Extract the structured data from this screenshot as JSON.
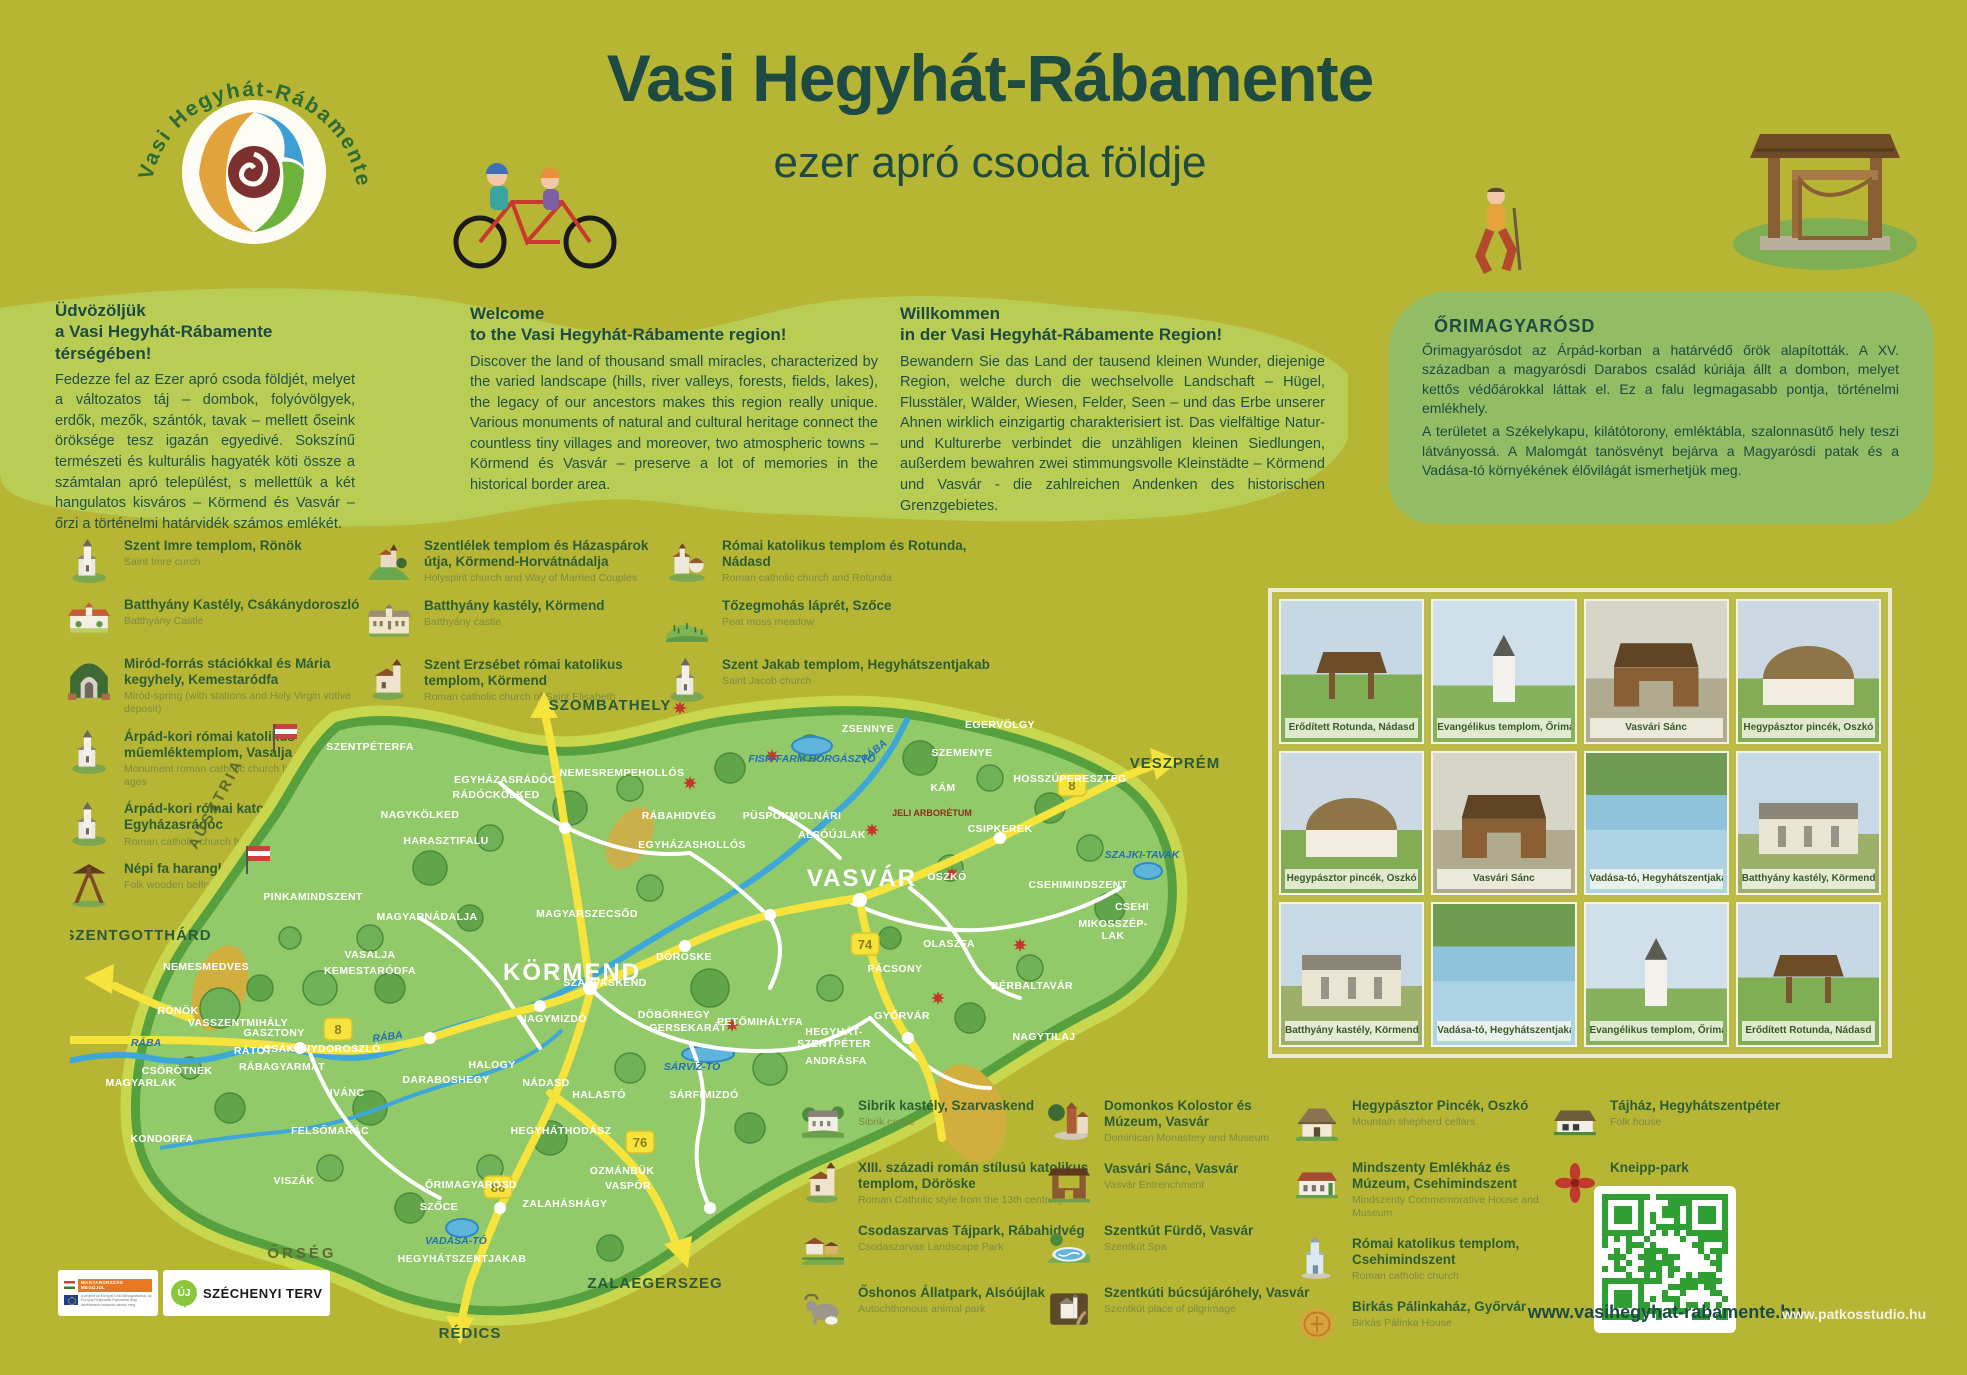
{
  "header": {
    "title": "Vasi Hegyhát-Rábamente",
    "subtitle": "ezer apró csoda földje",
    "logo_text": "Vasi Hegyhát-Rábamente"
  },
  "intro": {
    "hu": {
      "title1": "Üdvözöljük",
      "title2": "a Vasi Hegyhát-Rábamente térségében!",
      "body": "Fedezze fel az Ezer apró csoda földjét, melyet a változatos táj – dombok, folyóvölgyek, erdők, mezők, szántók, tavak – mellett őseink öröksége tesz igazán egyedivé. Sokszínű természeti és kulturális hagyaték köti össze a számtalan apró települést, s mellettük a két hangulatos kisváros – Körmend és Vasvár – őrzi a történelmi határvidék számos emlékét."
    },
    "en": {
      "title1": "Welcome",
      "title2": "to the Vasi Hegyhát-Rábamente region!",
      "body": "Discover the land of thousand small miracles, characterized by the varied landscape (hills, river valleys, forests, fields, lakes), the legacy of our ancestors makes this region really unique. Various monuments of natural and cultural heritage connect the countless tiny villages and moreover, two atmospheric towns – Körmend és Vasvár – preserve a lot of memories in the historical border area."
    },
    "de": {
      "title1": "Willkommen",
      "title2": "in der Vasi Hegyhát-Rábamente Region!",
      "body": "Bewandern Sie das Land der tausend kleinen Wunder, diejenige Region, welche durch die wechselvolle Landschaft – Hügel, Flusstäler, Wälder, Wiesen, Felder, Seen – und das Erbe unserer Ahnen wirklich einzigartig charakterisiert ist. Das vielfältige Natur- und Kulturerbe verbindet die unzähligen kleinen Siedlungen, außerdem bewahren zwei stimmungsvolle Kleinstädte – Körmend und Vasvár - die zahlreichen Andenken des historischen Grenzgebietes."
    },
    "ori": {
      "title": "ŐRIMAGYARÓSD",
      "body1": "Őrimagyarósdot az Árpád-korban a határvédő őrök alapították. A XV. században a magyarósdi Darabos család kúriája állt a dombon, melyet kettős védőárokkal láttak el. Ez a falu legmagasabb pontja, történelmi emlékhely.",
      "body2": "A területet a Székelykapu, kilátótorony, emléktábla, szalonnasütő hely teszi látványossá. A Malomgát tanösvényt bejárva a Magyarósdi patak és a Vadása-tó környékének élővilágát ismerhetjük meg."
    }
  },
  "legend_top": {
    "col1": [
      {
        "icon": "church",
        "title": "Szent Imre templom, Rönök",
        "sub": "Saint Imre curch"
      },
      {
        "icon": "castle",
        "title": "Batthyány Kastély, Csákánydoroszló",
        "sub": "Batthyány Castle"
      },
      {
        "icon": "grotto",
        "title": "Miród-forrás stációkkal és Mária kegyhely, Kemestaródfa",
        "sub": "Miród-spring (with stations and Holy Virgin votive deposit)"
      },
      {
        "icon": "church",
        "title": "Árpád-kori római katolikus műemléktemplom, Vasalja",
        "sub": "Monument roman catholic church from the Árpád-ages"
      },
      {
        "icon": "church",
        "title": "Árpád-kori római katolikus templom, Egyházasrádóc",
        "sub": "Roman catholic church from the Árpád-ages"
      },
      {
        "icon": "belfry",
        "title": "Népi fa harangláb, Daraboshegy",
        "sub": "Folk wooden belfry"
      }
    ],
    "col2": [
      {
        "icon": "hillchurch",
        "title": "Szentlélek templom és Házaspárok útja, Körmend-Horvátnádalja",
        "sub": "Holyspirit church and Way of Married Couples"
      },
      {
        "icon": "mansion",
        "title": "Batthyány kastély, Körmend",
        "sub": "Batthyány castle"
      },
      {
        "icon": "churchred",
        "title": "Szent Erzsébet római katolikus templom, Körmend",
        "sub": "Roman catholic church of Saint Elisabeth"
      }
    ],
    "col3": [
      {
        "icon": "rotunda",
        "title": "Római katolikus templom és Rotunda, Nádasd",
        "sub": "Roman catholic church and Rotunda"
      },
      {
        "icon": "meadow",
        "title": "Tőzegmohás láprét, Szőce",
        "sub": "Peat moss meadow"
      },
      {
        "icon": "church",
        "title": "Szent Jakab templom, Hegyhátszentjakab",
        "sub": "Saint Jacob church"
      }
    ]
  },
  "legend_bottom": {
    "col1": [
      {
        "icon": "manor",
        "title": "Sibrik kastély, Szarvaskend",
        "sub": "Sibrik castle"
      },
      {
        "icon": "churchred",
        "title": "XIII. századi román stílusú katolikus templom, Döröske",
        "sub": "Roman Catholic style from the 13th centrury"
      },
      {
        "icon": "farm",
        "title": "Csodaszarvas Tájpark, Rábahidvég",
        "sub": "Csodaszarvas Landscape Park"
      },
      {
        "icon": "cow",
        "title": "Őshonos Állatpark, Alsóújlak",
        "sub": "Autochthonous animal park"
      }
    ],
    "col2": [
      {
        "icon": "monastery",
        "title": "Domonkos Kolostor és Múzeum, Vasvár",
        "sub": "Dominican Monastery and Museum"
      },
      {
        "icon": "woodgate",
        "title": "Vasvári Sánc, Vasvár",
        "sub": "Vasvár Entrenchment"
      },
      {
        "icon": "pool",
        "title": "Szentkút Fürdő, Vasvár",
        "sub": "Szentkút Spa"
      },
      {
        "icon": "pilgrim",
        "title": "Szentkúti búcsújáróhely, Vasvár",
        "sub": "Szentkút place of pilgrimage"
      }
    ],
    "col3": [
      {
        "icon": "cellar",
        "title": "Hegypásztor Pincék, Oszkó",
        "sub": "Mountain shepherd cellars"
      },
      {
        "icon": "mindszenty",
        "title": "Mindszenty Emlékház és Múzeum, Csehimindszent",
        "sub": "Mindszenty Commemorative House and Museum"
      },
      {
        "icon": "churchblue",
        "title": "Római katolikus templom, Csehimindszent",
        "sub": "Roman catholic church"
      },
      {
        "icon": "coin",
        "title": "Birkás Pálinkaház, Győrvár",
        "sub": "Birkás Pálinka House"
      }
    ],
    "col4": [
      {
        "icon": "folkhouse",
        "title": "Tájház, Hegyhátszentpéter",
        "sub": "Folk house"
      },
      {
        "icon": "flower",
        "title": "Kneipp-park",
        "sub": ""
      }
    ]
  },
  "photo_grid": {
    "photos": [
      {
        "caption": "Erődített Rotunda, Nádasd",
        "kind": "wood"
      },
      {
        "caption": "Evangélikus templom, Őrimagyarósd",
        "kind": "church"
      },
      {
        "caption": "Vasvári Sánc",
        "kind": "gate"
      },
      {
        "caption": "Hegypásztor pincék, Oszkó",
        "kind": "thatch"
      },
      {
        "caption": "Hegypásztor pincék, Oszkó",
        "kind": "thatch"
      },
      {
        "caption": "Vasvári Sánc",
        "kind": "gate"
      },
      {
        "caption": "Vadása-tó, Hegyhátszentjakab",
        "kind": "lake"
      },
      {
        "caption": "Batthyány kastély, Körmend",
        "kind": "palace"
      },
      {
        "caption": "Batthyány kastély, Körmend",
        "kind": "palace"
      },
      {
        "caption": "Vadása-tó, Hegyhátszentjakab",
        "kind": "lake"
      },
      {
        "caption": "Evangélikus templom, Őrimagyarósd",
        "kind": "church"
      },
      {
        "caption": "Erődített Rotunda, Nádasd",
        "kind": "wood"
      }
    ]
  },
  "map": {
    "labels": [
      {
        "t": "SZOMBATHELY",
        "x": 540,
        "y": 22,
        "c": "ext"
      },
      {
        "t": "VESZPRÉM",
        "x": 1105,
        "y": 80,
        "c": "ext"
      },
      {
        "t": "SZENTGOTTHÁRD",
        "x": 68,
        "y": 252,
        "c": "ext"
      },
      {
        "t": "ZALAEGERSZEG",
        "x": 585,
        "y": 600,
        "c": "ext"
      },
      {
        "t": "RÉDICS",
        "x": 400,
        "y": 650,
        "c": "ext"
      },
      {
        "t": "ŐRSÉG",
        "x": 232,
        "y": 570,
        "c": "area"
      },
      {
        "t": "AUSZTRIA",
        "x": 150,
        "y": 118,
        "c": "area",
        "r": -62
      },
      {
        "t": "KÖRMEND",
        "x": 502,
        "y": 292,
        "c": "city"
      },
      {
        "t": "VASVÁR",
        "x": 792,
        "y": 198,
        "c": "city"
      },
      {
        "t": "RÁBA",
        "x": 806,
        "y": 66,
        "c": "water",
        "r": -40
      },
      {
        "t": "RÁBA",
        "x": 318,
        "y": 352,
        "c": "water",
        "r": -8
      },
      {
        "t": "RÁBA",
        "x": 76,
        "y": 358,
        "c": "water"
      },
      {
        "t": "FISH-FARM HORGÁSZTÓ",
        "x": 742,
        "y": 74,
        "c": "water"
      },
      {
        "t": "SZAJKI-TAVAK",
        "x": 1072,
        "y": 170,
        "c": "water"
      },
      {
        "t": "SÁRVÍZ-TÓ",
        "x": 622,
        "y": 382,
        "c": "water"
      },
      {
        "t": "VADÁSA-TÓ",
        "x": 386,
        "y": 556,
        "c": "water"
      },
      {
        "t": "JELI ARBORÉTUM",
        "x": 862,
        "y": 128,
        "c": "special"
      },
      {
        "t": "ZSENNYE",
        "x": 798,
        "y": 44,
        "c": "town"
      },
      {
        "t": "EGERVÖLGY",
        "x": 930,
        "y": 40,
        "c": "town"
      },
      {
        "t": "SZEMENYE",
        "x": 892,
        "y": 68,
        "c": "town"
      },
      {
        "t": "HOSSZÚPERESZTEG",
        "x": 1000,
        "y": 94,
        "c": "town"
      },
      {
        "t": "NEMESREMPEHOLLÓS",
        "x": 552,
        "y": 88,
        "c": "town"
      },
      {
        "t": "EGYHÁZASRÁDÓC",
        "x": 435,
        "y": 95,
        "c": "town"
      },
      {
        "t": "RÁDÓCKÖLKED",
        "x": 426,
        "y": 110,
        "c": "town"
      },
      {
        "t": "NAGYKÖLKED",
        "x": 350,
        "y": 130,
        "c": "town"
      },
      {
        "t": "HARASZTIFALU",
        "x": 376,
        "y": 156,
        "c": "town"
      },
      {
        "t": "PINKAMINDSZENT",
        "x": 243,
        "y": 212,
        "c": "town"
      },
      {
        "t": "SZENTPÉTERFA",
        "x": 300,
        "y": 62,
        "c": "town"
      },
      {
        "t": "MAGYARNÁDALJA",
        "x": 357,
        "y": 232,
        "c": "town"
      },
      {
        "t": "VASALJA",
        "x": 300,
        "y": 270,
        "c": "town"
      },
      {
        "t": "KEMESTARÓDFA",
        "x": 300,
        "y": 286,
        "c": "town"
      },
      {
        "t": "NEMESMEDVES",
        "x": 136,
        "y": 282,
        "c": "town"
      },
      {
        "t": "RÖNÖK",
        "x": 108,
        "y": 326,
        "c": "town"
      },
      {
        "t": "VASSZENTMIHÁLY",
        "x": 168,
        "y": 338,
        "c": "town"
      },
      {
        "t": "GASZTONY",
        "x": 204,
        "y": 348,
        "c": "town"
      },
      {
        "t": "RÁTÓT",
        "x": 183,
        "y": 366,
        "c": "town"
      },
      {
        "t": "CSÁKÁNYDOROSZLÓ",
        "x": 252,
        "y": 364,
        "c": "town"
      },
      {
        "t": "RÁBAGYARMAT",
        "x": 212,
        "y": 382,
        "c": "town"
      },
      {
        "t": "MAGYARLAK",
        "x": 71,
        "y": 398,
        "c": "town"
      },
      {
        "t": "CSÖRÖTNEK",
        "x": 107,
        "y": 386,
        "c": "town"
      },
      {
        "t": "KONDORFA",
        "x": 92,
        "y": 454,
        "c": "town"
      },
      {
        "t": "IVÁNC",
        "x": 277,
        "y": 408,
        "c": "town"
      },
      {
        "t": "FELSŐMARÁC",
        "x": 260,
        "y": 446,
        "c": "town"
      },
      {
        "t": "VISZÁK",
        "x": 224,
        "y": 496,
        "c": "town"
      },
      {
        "t": "SZŐCE",
        "x": 369,
        "y": 522,
        "c": "town"
      },
      {
        "t": "ŐRIMAGYARÓSD",
        "x": 401,
        "y": 500,
        "c": "town"
      },
      {
        "t": "HEGYHÁTSZENTJAKAB",
        "x": 392,
        "y": 574,
        "c": "town"
      },
      {
        "t": "ZALAHÁSHÁGY",
        "x": 495,
        "y": 519,
        "c": "town"
      },
      {
        "t": "DARABOSHEGY",
        "x": 376,
        "y": 395,
        "c": "town"
      },
      {
        "t": "HALOGY",
        "x": 422,
        "y": 380,
        "c": "town"
      },
      {
        "t": "NÁDASD",
        "x": 476,
        "y": 398,
        "c": "town"
      },
      {
        "t": "HEGYHÁTHODÁSZ",
        "x": 491,
        "y": 446,
        "c": "town"
      },
      {
        "t": "OZMÁNBÜK",
        "x": 552,
        "y": 486,
        "c": "town"
      },
      {
        "t": "VASPÖR",
        "x": 558,
        "y": 501,
        "c": "town"
      },
      {
        "t": "HALASTÓ",
        "x": 529,
        "y": 410,
        "c": "town"
      },
      {
        "t": "MAGYARSZECSŐD",
        "x": 517,
        "y": 229,
        "c": "town"
      },
      {
        "t": "RÁBAHIDVÉG",
        "x": 609,
        "y": 131,
        "c": "town"
      },
      {
        "t": "PÜSPÖKMOLNÁRI",
        "x": 722,
        "y": 131,
        "c": "town"
      },
      {
        "t": "EGYHÁZASHOLLÓS",
        "x": 622,
        "y": 160,
        "c": "town"
      },
      {
        "t": "DÖRÖSKE",
        "x": 614,
        "y": 272,
        "c": "town"
      },
      {
        "t": "DÖBÖRHEGY",
        "x": 604,
        "y": 330,
        "c": "town"
      },
      {
        "t": "GERSEKARÁT",
        "x": 618,
        "y": 343,
        "c": "town"
      },
      {
        "t": "SZARVASKEND",
        "x": 535,
        "y": 298,
        "c": "town"
      },
      {
        "t": "NAGYMIZDÓ",
        "x": 483,
        "y": 334,
        "c": "town"
      },
      {
        "t": "SÁRFIMIZDÓ",
        "x": 634,
        "y": 410,
        "c": "town"
      },
      {
        "t": "PETŐMIHÁLYFA",
        "x": 690,
        "y": 337,
        "c": "town"
      },
      {
        "t": "HEGYHÁT-",
        "x": 764,
        "y": 347,
        "c": "town"
      },
      {
        "t": "SZENTPÉTER",
        "x": 764,
        "y": 359,
        "c": "town"
      },
      {
        "t": "ANDRÁSFA",
        "x": 766,
        "y": 376,
        "c": "town"
      },
      {
        "t": "GYŐRVÁR",
        "x": 832,
        "y": 331,
        "c": "town"
      },
      {
        "t": "ALSÓÚJLAK",
        "x": 762,
        "y": 150,
        "c": "town"
      },
      {
        "t": "OSZKÓ",
        "x": 877,
        "y": 192,
        "c": "town"
      },
      {
        "t": "OLASZFA",
        "x": 879,
        "y": 259,
        "c": "town"
      },
      {
        "t": "PÁCSONY",
        "x": 825,
        "y": 284,
        "c": "town"
      },
      {
        "t": "BÉRBALTAVÁR",
        "x": 962,
        "y": 301,
        "c": "town"
      },
      {
        "t": "NAGYTILAJ",
        "x": 974,
        "y": 352,
        "c": "town"
      },
      {
        "t": "CSEHI",
        "x": 1062,
        "y": 222,
        "c": "town"
      },
      {
        "t": "CSEHIMINDSZENT",
        "x": 1008,
        "y": 200,
        "c": "town"
      },
      {
        "t": "MIKOSSZÉP-",
        "x": 1043,
        "y": 239,
        "c": "town"
      },
      {
        "t": "LAK",
        "x": 1043,
        "y": 251,
        "c": "town"
      },
      {
        "t": "CSIPKEREK",
        "x": 930,
        "y": 144,
        "c": "town"
      },
      {
        "t": "KÁM",
        "x": 873,
        "y": 103,
        "c": "town"
      }
    ],
    "shields": [
      {
        "n": "8",
        "x": 268,
        "y": 342
      },
      {
        "n": "8",
        "x": 1002,
        "y": 98
      },
      {
        "n": "74",
        "x": 795,
        "y": 257
      },
      {
        "n": "76",
        "x": 570,
        "y": 455
      },
      {
        "n": "86",
        "x": 428,
        "y": 500
      }
    ],
    "flowers": [
      {
        "x": 620,
        "y": 95
      },
      {
        "x": 702,
        "y": 68
      },
      {
        "x": 802,
        "y": 142
      },
      {
        "x": 882,
        "y": 186
      },
      {
        "x": 950,
        "y": 257
      },
      {
        "x": 868,
        "y": 310
      },
      {
        "x": 662,
        "y": 337
      },
      {
        "x": 610,
        "y": 20
      }
    ]
  },
  "footer": {
    "eu_title": "MAGYARORSZÁG MEGÚJUL",
    "eu_note": "A projekt az Európai Unió támogatásával, az Európai Regionális Fejlesztési Alap társfinanszírozásával valósul meg.",
    "szechenyi_uj": "ÚJ",
    "szechenyi": "SZÉCHENYI TERV",
    "site1": "www.vasihegyhat-rabamente.hu",
    "site2": "www.patkosstudio.hu"
  }
}
